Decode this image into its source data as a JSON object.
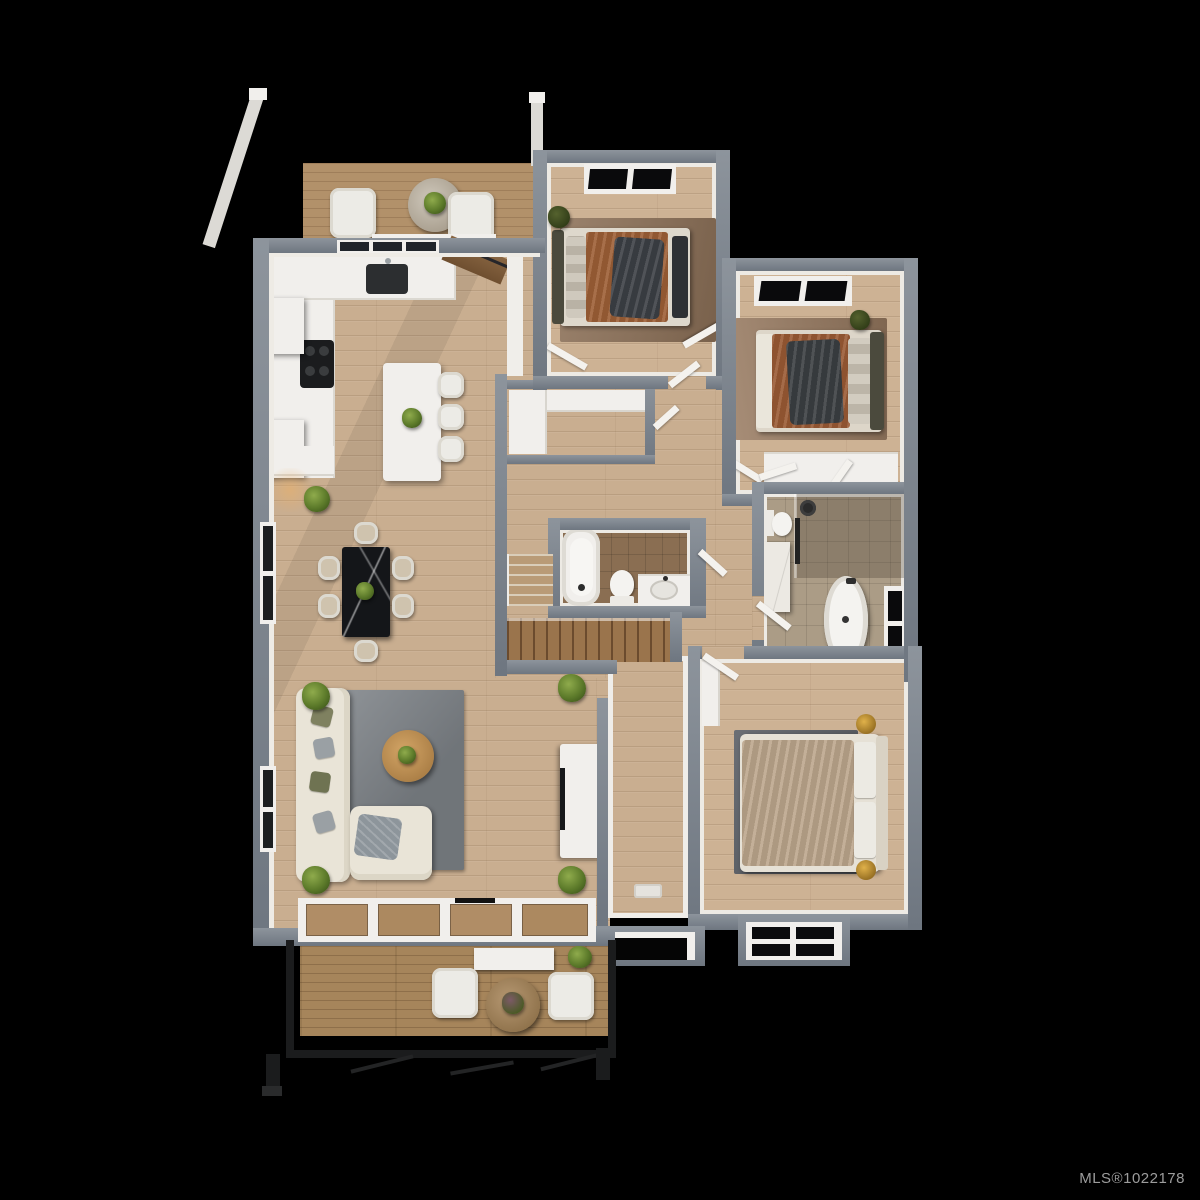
{
  "watermark": {
    "label": "MLS®1022178",
    "color": "#9c9c9c"
  },
  "scene": {
    "type": "3d-top-down-floor-plan-render",
    "background_color": "#000000",
    "palette": {
      "wall_gray": "#79818a",
      "interior_wall_face": "#edeae4",
      "main_wood_floor": "#c9ae90",
      "balcony_deck": "#b2916a",
      "lower_deck": "#a6855b",
      "main_bath_tile": "#8a6e52",
      "ensuite_tile": "#ab9c86",
      "living_rug": "#7d8287",
      "bedroom_rug_brown": "#8d7158",
      "bedroom3_rug": "#5a5e65",
      "rust_duvet": "#9a5a34",
      "dark_throw": "#3c4045",
      "champagne_bedding": "#bca68c",
      "gold_nightstand": "#c9972f",
      "railing_black": "#1b1c1d"
    },
    "rooms": [
      {
        "name": "upper-balcony",
        "furniture": [
          "two white lounge chairs",
          "round stone table with plant",
          "white support beams"
        ]
      },
      {
        "name": "kitchen",
        "furniture": [
          "L-shaped white counter",
          "dark sink",
          "black cooktop",
          "floating wall cabinets",
          "white island with plant",
          "three bar stools",
          "glazed backsplash window"
        ]
      },
      {
        "name": "dining-area",
        "furniture": [
          "black marble dining table",
          "six beige chairs",
          "potted plants",
          "side window"
        ]
      },
      {
        "name": "living-room",
        "furniture": [
          "cream L-shaped sectional sofa with pillows",
          "gray area rug",
          "round wood coffee table with plant",
          "white media console with TV",
          "corner potted plants",
          "glazed door wall to deck",
          "side window"
        ]
      },
      {
        "name": "bedroom-1-top",
        "furniture": [
          "double bed with rust duvet and dark throw",
          "olive headboard",
          "brown rug",
          "plant",
          "closet with open angled doors",
          "black window"
        ]
      },
      {
        "name": "bedroom-2-top-right",
        "furniture": [
          "double bed with rust duvet and dark throw",
          "olive headboard",
          "brown rug",
          "plant",
          "built-in closet row with angled doors",
          "black window"
        ]
      },
      {
        "name": "walk-in-closet",
        "furniture": [
          "white L-shaped wardrobe"
        ]
      },
      {
        "name": "main-bathroom",
        "furniture": [
          "built-in bathtub",
          "toilet",
          "white vanity with sink"
        ]
      },
      {
        "name": "ensuite-bathroom",
        "furniture": [
          "freestanding oval tub",
          "rain shower with glass screen",
          "toilet",
          "marble column",
          "black window",
          "white bench"
        ]
      },
      {
        "name": "bedroom-3-bottom-right",
        "furniture": [
          "double bed with champagne bedding and white pillows",
          "dark gray rug",
          "two gold round nightstands",
          "small closet",
          "window bay with black panes"
        ]
      },
      {
        "name": "stair-hall",
        "furniture": [
          "upper stair flight",
          "main wood staircase down"
        ]
      },
      {
        "name": "entry-corridor",
        "furniture": [
          "door mat",
          "entry door opening"
        ]
      },
      {
        "name": "lower-deck",
        "furniture": [
          "two white armchairs",
          "round wood table with plant",
          "white console",
          "black metal railing and legs",
          "corner plants"
        ]
      }
    ]
  }
}
